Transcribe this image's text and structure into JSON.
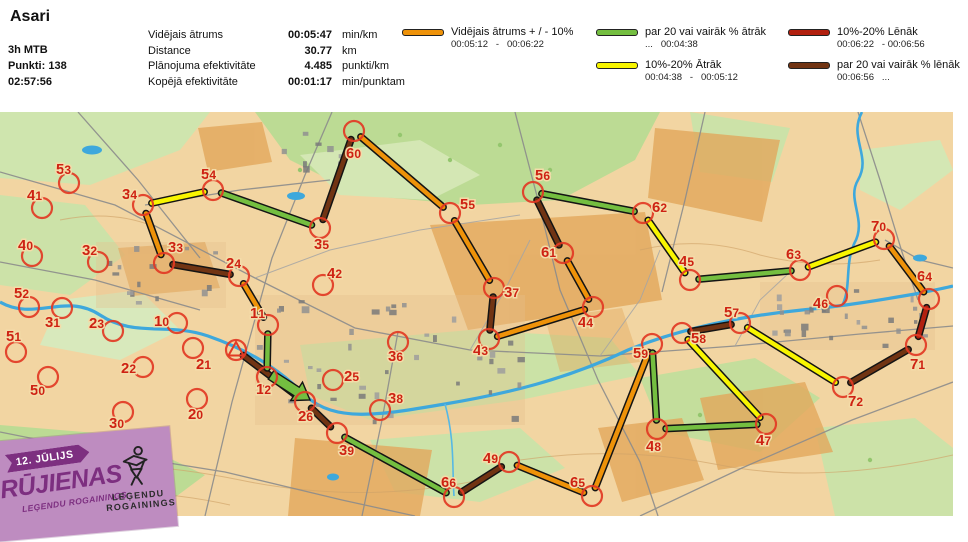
{
  "header": {
    "title": "Asari",
    "class": "3h MTB",
    "points": "Punkti: 138",
    "time": "02:57:56",
    "stats": [
      {
        "label": "Vidējais ātrums",
        "value": "00:05:47",
        "unit": "min/km"
      },
      {
        "label": "Distance",
        "value": "30.77",
        "unit": "km"
      },
      {
        "label": "Plānojuma efektivitāte",
        "value": "4.485",
        "unit": "punkti/km"
      },
      {
        "label": "Kopējā efektivitāte",
        "value": "00:01:17",
        "unit": "min/punktam"
      }
    ],
    "legend": [
      {
        "color_key": "orange",
        "label": "Vidējais ātrums + / - 10%",
        "range": "00:05:12   -   00:06:22",
        "col": 1,
        "row": 1
      },
      {
        "color_key": "green",
        "label": "par 20 vai vairāk % ātrāk",
        "range": "...   00:04:38",
        "col": 2,
        "row": 1
      },
      {
        "color_key": "yellow",
        "label": "10%-20% Ātrāk",
        "range": "00:04:38   -   00:05:12",
        "col": 2,
        "row": 2
      },
      {
        "color_key": "red",
        "label": "10%-20% Lēnāk",
        "range": "00:06:22   - 00:06:56",
        "col": 3,
        "row": 1
      },
      {
        "color_key": "brown",
        "label": "par 20 vai vairāk % lēnāk",
        "range": "00:06:56   ...",
        "col": 3,
        "row": 2
      }
    ]
  },
  "badge": {
    "date": "12. JŪLIJS",
    "title": "RŪJIENAS",
    "subtitle": "LEĢENDU ROGAININGS",
    "logo_line1": "LEĢENDU",
    "logo_line2": "ROGAININGS"
  },
  "map": {
    "colors": {
      "orange": "#EE9209",
      "green": "#74BE40",
      "yellow": "#F8F500",
      "red": "#B2200F",
      "brown": "#713413",
      "control_ring": "#E23A24",
      "control_label": "#CE2213"
    },
    "start": {
      "x": 236,
      "y": 350
    },
    "finish_arrow": {
      "from": [
        271,
        375
      ],
      "to": [
        310,
        400
      ]
    },
    "controls": [
      {
        "id": "10",
        "x": 177,
        "y": 323,
        "lx": 154,
        "ly": 326
      },
      {
        "id": "11",
        "x": 268,
        "y": 325,
        "lx": 250,
        "ly": 318
      },
      {
        "id": "12",
        "x": 267,
        "y": 377,
        "lx": 256,
        "ly": 394
      },
      {
        "id": "20",
        "x": 197,
        "y": 399,
        "lx": 188,
        "ly": 419
      },
      {
        "id": "21",
        "x": 193,
        "y": 348,
        "lx": 196,
        "ly": 369
      },
      {
        "id": "22",
        "x": 143,
        "y": 367,
        "lx": 121,
        "ly": 373
      },
      {
        "id": "23",
        "x": 113,
        "y": 331,
        "lx": 89,
        "ly": 328
      },
      {
        "id": "24",
        "x": 239,
        "y": 276,
        "lx": 226,
        "ly": 268
      },
      {
        "id": "25",
        "x": 333,
        "y": 380,
        "lx": 344,
        "ly": 381
      },
      {
        "id": "26",
        "x": 305,
        "y": 402,
        "lx": 298,
        "ly": 421
      },
      {
        "id": "30",
        "x": 123,
        "y": 412,
        "lx": 109,
        "ly": 428
      },
      {
        "id": "31",
        "x": 62,
        "y": 308,
        "lx": 45,
        "ly": 327
      },
      {
        "id": "32",
        "x": 98,
        "y": 262,
        "lx": 82,
        "ly": 255
      },
      {
        "id": "33",
        "x": 164,
        "y": 263,
        "lx": 168,
        "ly": 252
      },
      {
        "id": "34",
        "x": 143,
        "y": 205,
        "lx": 122,
        "ly": 199
      },
      {
        "id": "35",
        "x": 320,
        "y": 228,
        "lx": 314,
        "ly": 249
      },
      {
        "id": "36",
        "x": 398,
        "y": 342,
        "lx": 388,
        "ly": 361
      },
      {
        "id": "37",
        "x": 494,
        "y": 288,
        "lx": 504,
        "ly": 297
      },
      {
        "id": "38",
        "x": 380,
        "y": 410,
        "lx": 388,
        "ly": 403
      },
      {
        "id": "39",
        "x": 337,
        "y": 433,
        "lx": 339,
        "ly": 455
      },
      {
        "id": "40",
        "x": 32,
        "y": 256,
        "lx": 18,
        "ly": 250
      },
      {
        "id": "41",
        "x": 42,
        "y": 208,
        "lx": 27,
        "ly": 200
      },
      {
        "id": "42",
        "x": 323,
        "y": 285,
        "lx": 327,
        "ly": 278
      },
      {
        "id": "43",
        "x": 489,
        "y": 339,
        "lx": 473,
        "ly": 355
      },
      {
        "id": "44",
        "x": 593,
        "y": 307,
        "lx": 578,
        "ly": 327
      },
      {
        "id": "45",
        "x": 690,
        "y": 280,
        "lx": 679,
        "ly": 266
      },
      {
        "id": "46",
        "x": 837,
        "y": 296,
        "lx": 813,
        "ly": 308
      },
      {
        "id": "47",
        "x": 766,
        "y": 424,
        "lx": 756,
        "ly": 445
      },
      {
        "id": "48",
        "x": 657,
        "y": 429,
        "lx": 646,
        "ly": 451
      },
      {
        "id": "49",
        "x": 509,
        "y": 462,
        "lx": 483,
        "ly": 463
      },
      {
        "id": "50",
        "x": 48,
        "y": 377,
        "lx": 30,
        "ly": 395
      },
      {
        "id": "51",
        "x": 16,
        "y": 352,
        "lx": 6,
        "ly": 341
      },
      {
        "id": "52",
        "x": 29,
        "y": 307,
        "lx": 14,
        "ly": 298
      },
      {
        "id": "53",
        "x": 69,
        "y": 183,
        "lx": 56,
        "ly": 174
      },
      {
        "id": "54",
        "x": 213,
        "y": 190,
        "lx": 201,
        "ly": 179
      },
      {
        "id": "55",
        "x": 450,
        "y": 213,
        "lx": 460,
        "ly": 209
      },
      {
        "id": "56",
        "x": 533,
        "y": 192,
        "lx": 535,
        "ly": 180
      },
      {
        "id": "57",
        "x": 740,
        "y": 323,
        "lx": 724,
        "ly": 317
      },
      {
        "id": "58",
        "x": 682,
        "y": 333,
        "lx": 691,
        "ly": 343
      },
      {
        "id": "59",
        "x": 652,
        "y": 344,
        "lx": 633,
        "ly": 358
      },
      {
        "id": "60",
        "x": 354,
        "y": 131,
        "lx": 346,
        "ly": 158
      },
      {
        "id": "61",
        "x": 563,
        "y": 253,
        "lx": 541,
        "ly": 257
      },
      {
        "id": "62",
        "x": 643,
        "y": 213,
        "lx": 652,
        "ly": 212
      },
      {
        "id": "63",
        "x": 800,
        "y": 270,
        "lx": 786,
        "ly": 259
      },
      {
        "id": "64",
        "x": 929,
        "y": 299,
        "lx": 917,
        "ly": 281
      },
      {
        "id": "65",
        "x": 592,
        "y": 496,
        "lx": 570,
        "ly": 487
      },
      {
        "id": "66",
        "x": 454,
        "y": 497,
        "lx": 441,
        "ly": 487
      },
      {
        "id": "70",
        "x": 884,
        "y": 239,
        "lx": 871,
        "ly": 231
      },
      {
        "id": "71",
        "x": 916,
        "y": 345,
        "lx": 910,
        "ly": 369
      },
      {
        "id": "72",
        "x": 843,
        "y": 387,
        "lx": 848,
        "ly": 406
      }
    ],
    "segments": [
      {
        "a": "start",
        "b": "26",
        "color": "brown"
      },
      {
        "a": "26",
        "b": "39",
        "color": "brown"
      },
      {
        "a": "39",
        "b": "66",
        "color": "green"
      },
      {
        "a": "66",
        "b": "49",
        "color": "brown"
      },
      {
        "a": "49",
        "b": "65",
        "color": "orange"
      },
      {
        "a": "65",
        "b": "59",
        "color": "orange"
      },
      {
        "a": "59",
        "b": "48",
        "color": "green"
      },
      {
        "a": "48",
        "b": "47",
        "color": "green"
      },
      {
        "a": "47",
        "b": "58",
        "color": "yellow"
      },
      {
        "a": "58",
        "b": "57",
        "color": "brown"
      },
      {
        "a": "57",
        "b": "72",
        "color": "yellow"
      },
      {
        "a": "72",
        "b": "71",
        "color": "brown"
      },
      {
        "a": "71",
        "b": "64",
        "color": "red"
      },
      {
        "a": "64",
        "b": "70",
        "color": "orange"
      },
      {
        "a": "70",
        "b": "63",
        "color": "yellow"
      },
      {
        "a": "63",
        "b": "45",
        "color": "green"
      },
      {
        "a": "45",
        "b": "62",
        "color": "yellow"
      },
      {
        "a": "62",
        "b": "56",
        "color": "green"
      },
      {
        "a": "56",
        "b": "61",
        "color": "brown"
      },
      {
        "a": "61",
        "b": "44",
        "color": "orange"
      },
      {
        "a": "44",
        "b": "43",
        "color": "orange"
      },
      {
        "a": "43",
        "b": "37",
        "color": "brown"
      },
      {
        "a": "37",
        "b": "55",
        "color": "orange"
      },
      {
        "a": "55",
        "b": "60",
        "color": "orange"
      },
      {
        "a": "60",
        "b": "35",
        "color": "brown"
      },
      {
        "a": "35",
        "b": "54",
        "color": "green"
      },
      {
        "a": "54",
        "b": "34",
        "color": "yellow"
      },
      {
        "a": "34",
        "b": "33",
        "color": "orange"
      },
      {
        "a": "33",
        "b": "24",
        "color": "brown"
      },
      {
        "a": "24",
        "b": "11",
        "color": "orange"
      },
      {
        "a": "11",
        "b": "12",
        "color": "green"
      }
    ]
  }
}
